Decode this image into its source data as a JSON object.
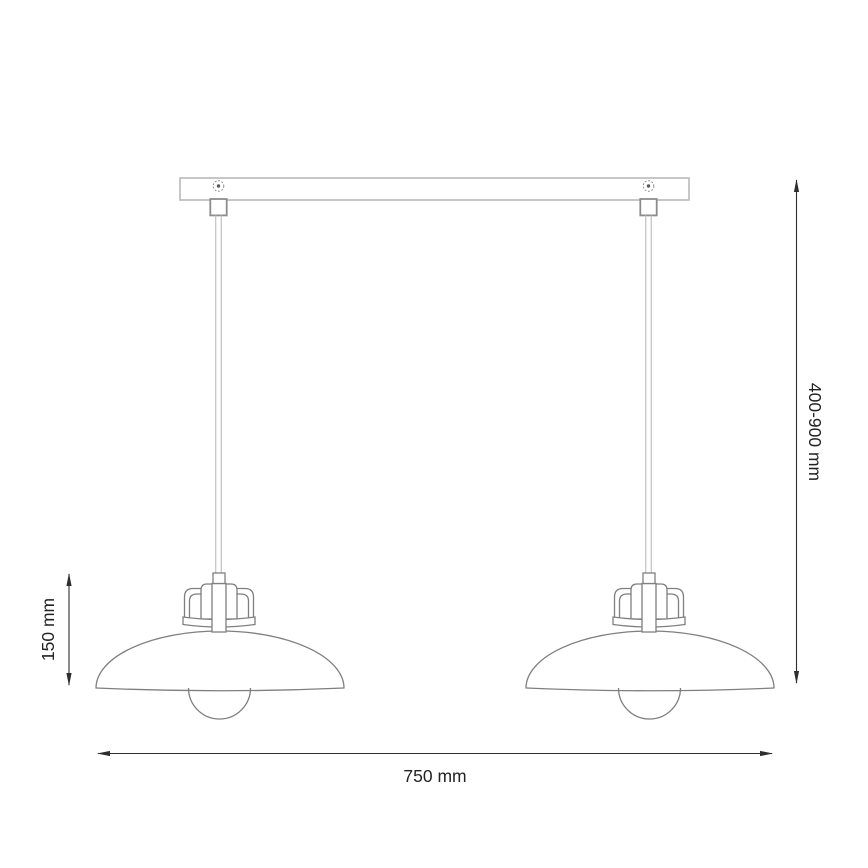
{
  "diagram": {
    "subject": "Two-shade pendant ceiling lamp - dimensioned technical drawing",
    "labels": {
      "width": "750 mm",
      "suspension_height": "400-900 mm",
      "shade_height": "150 mm"
    },
    "values": {
      "width_mm": 750,
      "suspension_min_mm": 400,
      "suspension_max_mm": 900,
      "shade_height_mm": 150
    },
    "colors": {
      "background": "#ffffff",
      "lamp_line": "#7f7f7f",
      "mount_line": "#b9b9b9",
      "connector_line": "#8c8c8c",
      "cord_line": "#c6c6c6",
      "dimension_line": "#2e2e2e",
      "text": "#222222"
    }
  }
}
